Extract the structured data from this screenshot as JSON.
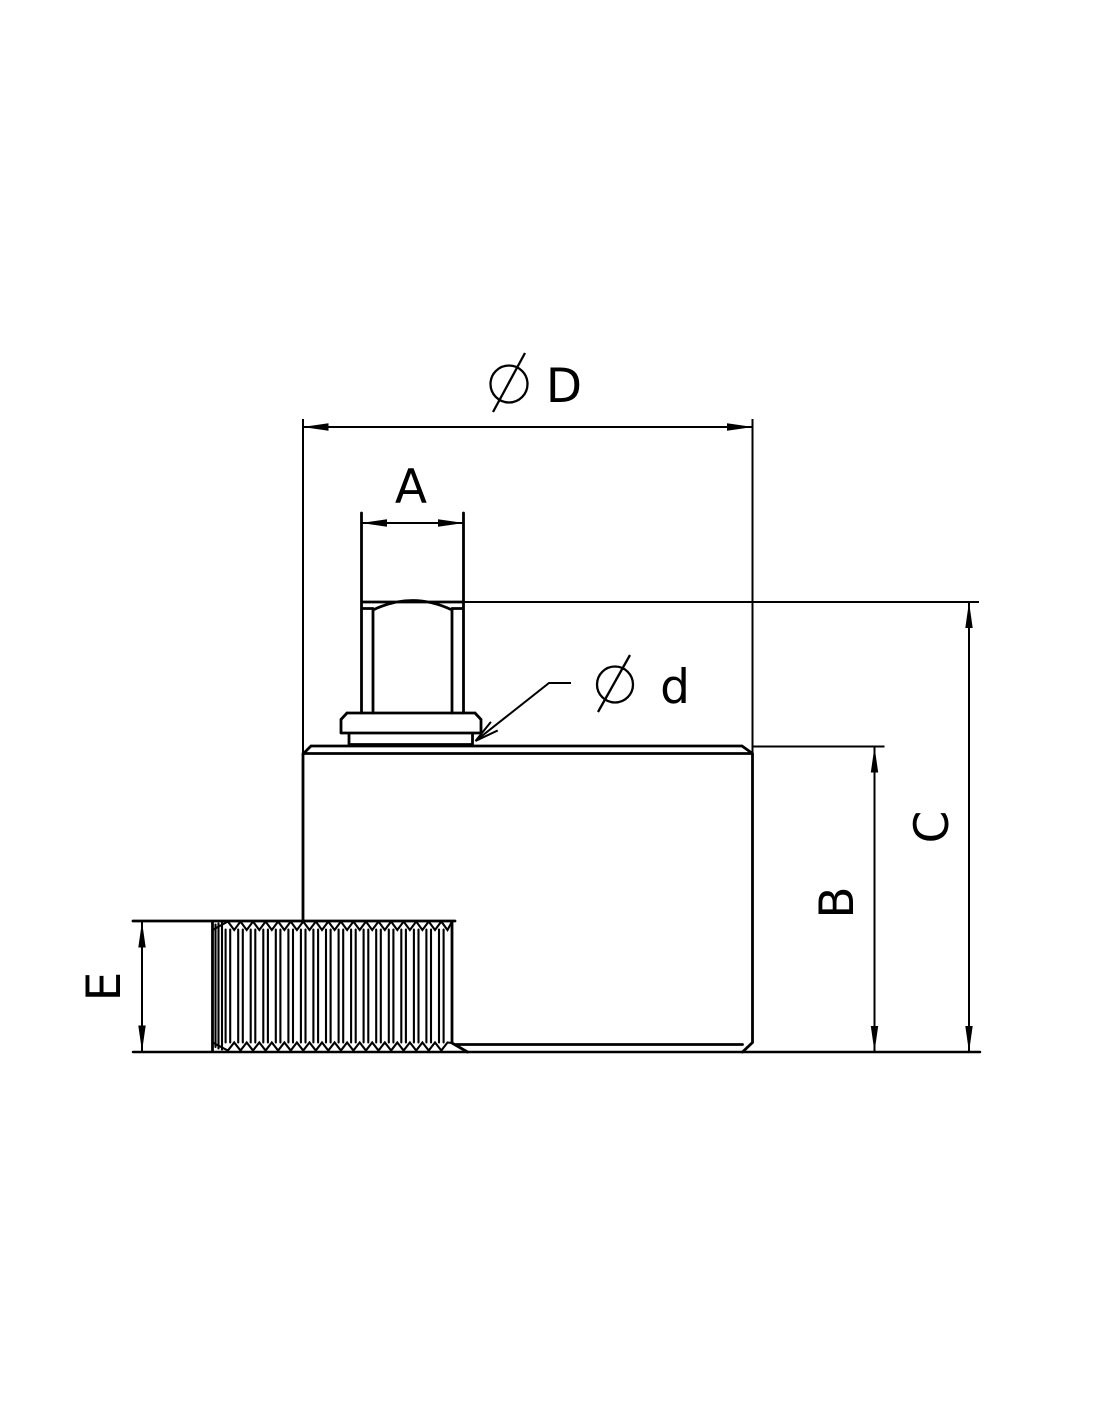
{
  "drawing": {
    "type": "technical-dimension-drawing",
    "background_color": "#ffffff",
    "line_color": "#000000",
    "dimensions": {
      "outer_diameter": {
        "symbol": "⌀",
        "letter": "D",
        "full_label": "⌀D"
      },
      "top_connector_width": {
        "symbol": "",
        "letter": "A",
        "full_label": "A"
      },
      "collar_diameter": {
        "symbol": "⌀",
        "letter": "d",
        "full_label": "⌀d"
      },
      "body_height": {
        "symbol": "",
        "letter": "B",
        "full_label": "B"
      },
      "overall_height": {
        "symbol": "",
        "letter": "C",
        "full_label": "C"
      },
      "knurl_height": {
        "symbol": "",
        "letter": "E",
        "full_label": "E"
      }
    }
  }
}
